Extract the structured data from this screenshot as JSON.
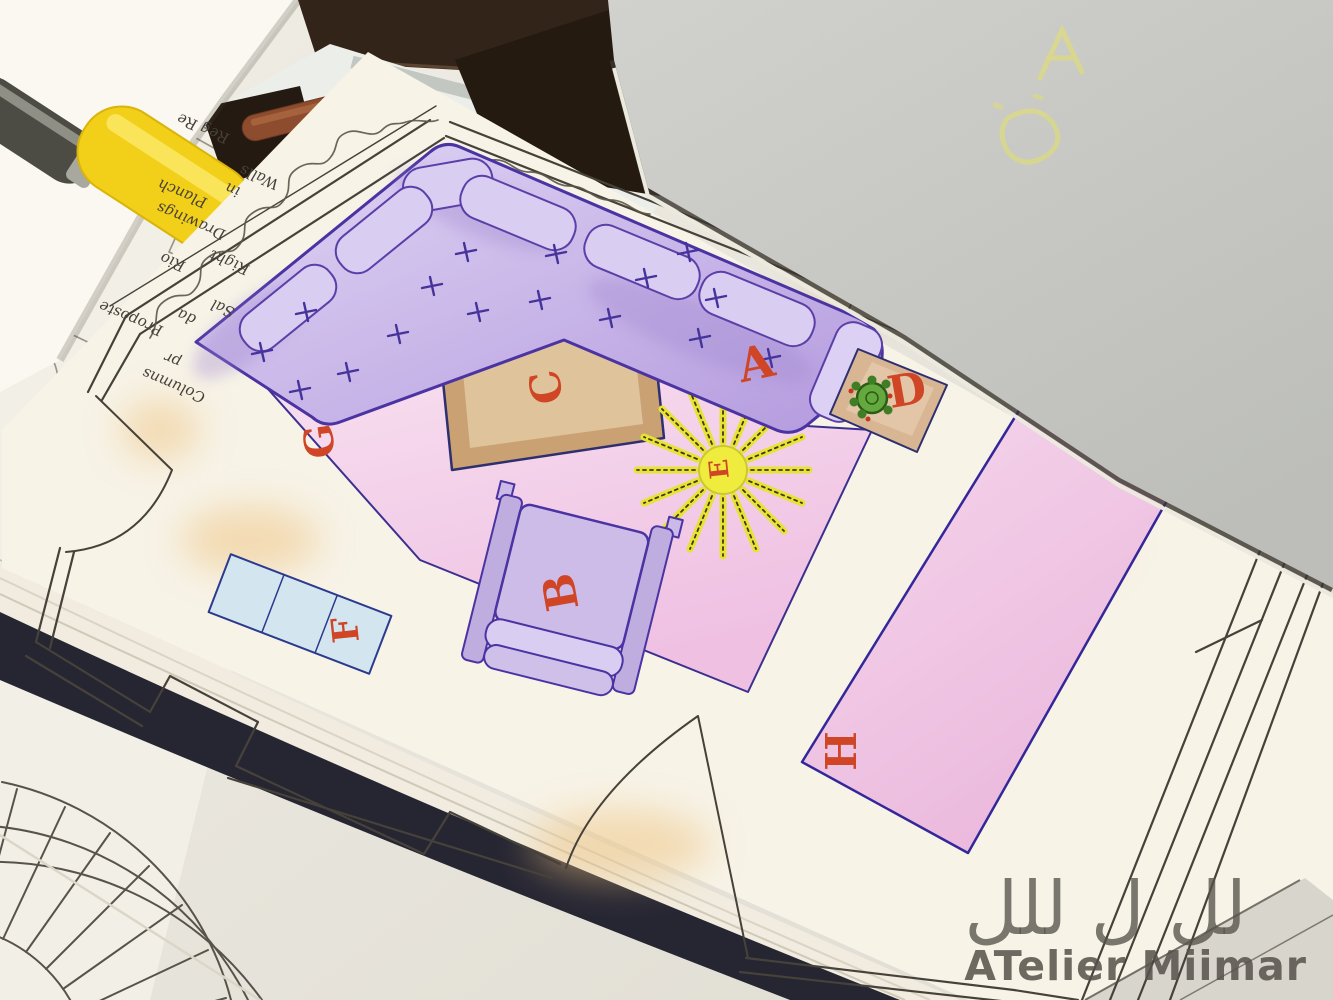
{
  "floor_plan": {
    "labels": {
      "sofa": "A",
      "armchair": "B",
      "coffee_table": "C",
      "side_table": "D",
      "plant": "E",
      "cabinet": "F",
      "rug": "G",
      "long_table": "H"
    },
    "label_color": "#cf4526"
  },
  "note_paper": {
    "lines": [
      "Columns",
      "pr",
      "Proposte",
      "da",
      "Sal",
      "Rio",
      "Right",
      "Drawings",
      "Planch",
      "in",
      "Walls",
      "Reg Re"
    ]
  },
  "watermark": {
    "logo_glyphs": "لل ل للل",
    "title": "ATelier Miimar",
    "color": "#5b564e"
  },
  "colors": {
    "sofa_purple": "#c8b7e6",
    "sofa_outline": "#4a33a2",
    "rug_pink": "#f3c9e6",
    "coffee_table_brown": "#c9a071",
    "side_table_tan": "#d7b494",
    "cabinet_blue": "#d3e6f0",
    "long_table_pink": "#f0c4e3",
    "plant_green": "#63a93e",
    "sunburst_yellow": "#ece73a",
    "label_red": "#cf4526",
    "cover_navy": "#262633",
    "pen_cap_yellow": "#f2cf18",
    "pen_brown": "#8d4c2e",
    "facing_page_grey": "#c9c9c5",
    "page_cream": "#f7f3e7"
  }
}
